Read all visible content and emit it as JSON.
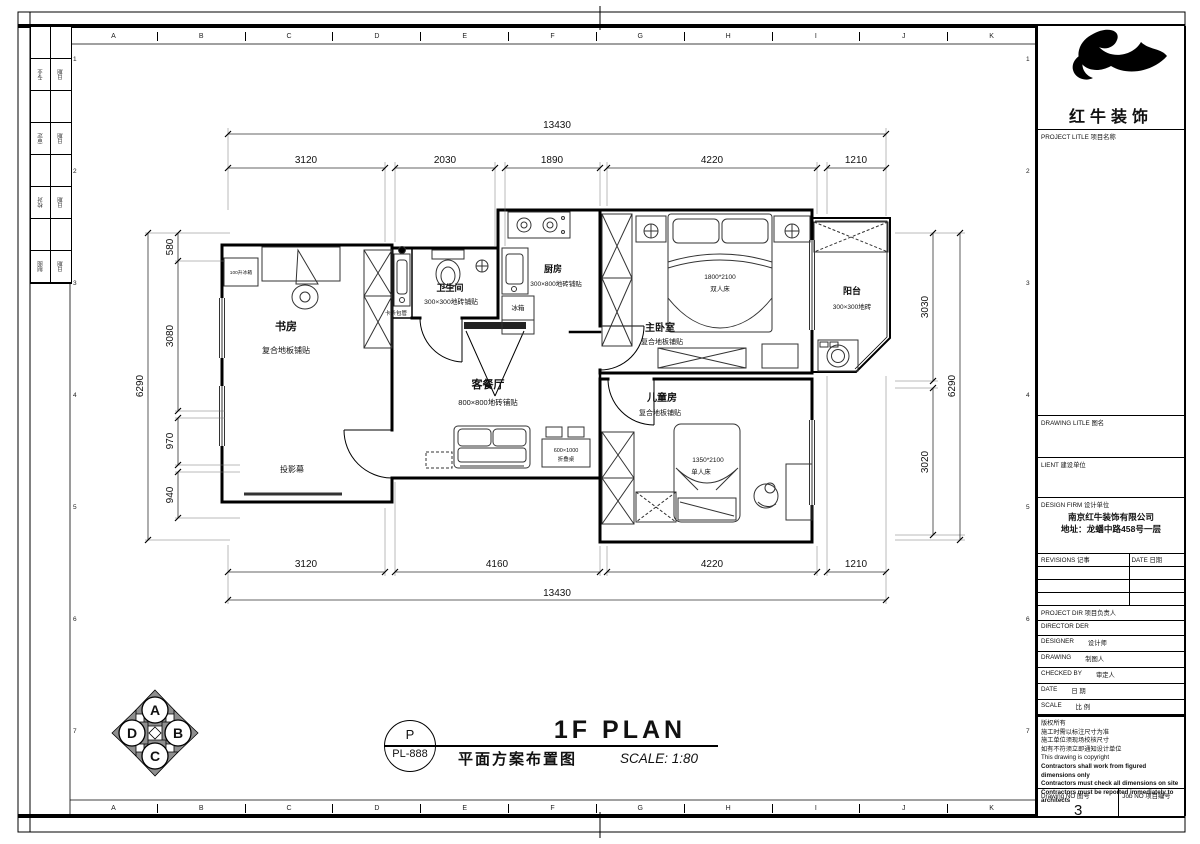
{
  "sheet": {
    "grid_letters": [
      "A",
      "B",
      "C",
      "D",
      "E",
      "F",
      "G",
      "H",
      "I",
      "J",
      "K"
    ],
    "row_numbers": [
      "1",
      "2",
      "3",
      "4",
      "5",
      "6",
      "7"
    ],
    "sig": [
      [
        "专业",
        "日期"
      ],
      [
        "审定",
        "日期"
      ],
      [
        "校对",
        "日期"
      ],
      [
        "制图",
        "日期"
      ]
    ]
  },
  "brand": {
    "name": "红牛装饰"
  },
  "title_block": {
    "project_label": "PROJECT LITLE  项目名称",
    "drawing_label": "DRAWING LITLE  图名",
    "client_label": "LIENT  建设单位",
    "firm_label": "DESIGN FIRM  设计单位",
    "firm_name": "南京红牛装饰有限公司",
    "firm_addr": "地址：龙蟠中路458号一层",
    "revisions_label": "REVISIONS  记事",
    "date_col_label": "DATE  日期",
    "project_dir": "PROJECT DIR  项目负责人",
    "director": "DIRECTOR DER",
    "designer_en": "DESIGNER",
    "designer_cn": "设计师",
    "drawing_en": "DRAWING",
    "drawing_cn": "制图人",
    "checked_en": "CHECKED BY",
    "checked_cn": "审定人",
    "date_en": "DATE",
    "date_cn": "日 期",
    "scale_en": "SCALE",
    "scale_cn": "比 例",
    "notes": [
      "版权所有",
      "施工时需以标注尺寸为准",
      "施工单位须现场校核尺寸",
      "如有不符须立即通知设计单位",
      "This drawing is copyright",
      "Contractors shall work from figured dimensions only",
      "Contractors must check all dimensions on site",
      "Contractors must be reported immediately to architects"
    ],
    "drawing_no_label": "Drawing NO  图号",
    "drawing_no": "3",
    "job_no_label": "Job NO  项目编号"
  },
  "rooms": {
    "study": {
      "name": "书房",
      "floor": "复合地板铺贴",
      "screen": "投影幕",
      "fridge": "100升冰箱"
    },
    "bath": {
      "name": "卫生间",
      "floor": "300×300地砖铺贴",
      "pipe": "卡条包管"
    },
    "kitchen": {
      "name": "厨房",
      "floor": "300×800地砖铺贴",
      "fridge": "冰箱"
    },
    "master": {
      "name": "主卧室",
      "floor": "复合地板铺贴",
      "bed_size": "1800*2100",
      "bed_type": "双人床"
    },
    "balcony": {
      "name": "阳台",
      "floor": "300×300地砖"
    },
    "living": {
      "name": "客餐厅",
      "floor": "800×800地砖铺贴",
      "table_size": "600×1000",
      "table_type": "折叠桌"
    },
    "kids": {
      "name": "儿童房",
      "floor": "复合地板铺贴",
      "bed_size": "1350*2100",
      "bed_type": "单人床"
    }
  },
  "dims": {
    "top_total": "13430",
    "top": [
      "3120",
      "2030",
      "1890",
      "4220",
      "1210"
    ],
    "bottom": [
      "3120",
      "4160",
      "4220",
      "1210"
    ],
    "bottom_total": "13430",
    "left": [
      "580",
      "3080",
      "970",
      "940"
    ],
    "left_total": "6290",
    "right": [
      "3030",
      "3020"
    ],
    "right_total": "6290"
  },
  "footer": {
    "p": "P",
    "code": "PL-888",
    "title_en": "1F PLAN",
    "title_cn": "平面方案布置图",
    "scale": "SCALE: 1:80"
  },
  "compass": {
    "letters": [
      "A",
      "B",
      "C",
      "D"
    ]
  }
}
